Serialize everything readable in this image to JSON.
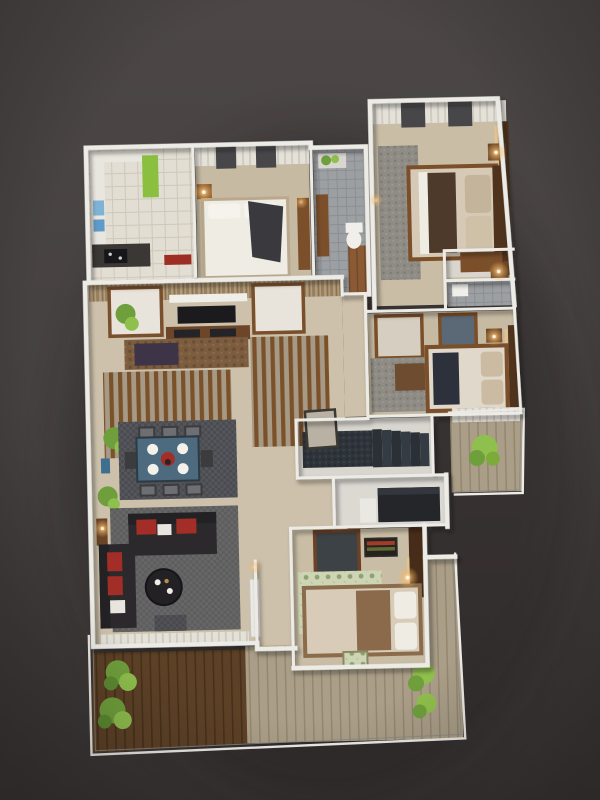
{
  "scene": {
    "type": "3d-floor-plan-render",
    "view": "top-down axonometric apartment floor plan on dark studio backdrop",
    "title": "",
    "visible_text": ""
  },
  "colors": {
    "bg-top": "#4c4746",
    "bg-bottom": "#393534",
    "shadow": "#242120",
    "wall": "#edebe6",
    "floor-living": "#cdc1ab",
    "floor-bed": "#c6baa3",
    "floor-master": "#c9bda6",
    "floor-kitchen": "#e3ded3",
    "bath-tile": "#9da0a3",
    "curtain-light": "#e4e1d9",
    "curtain-dark": "#d0ccc2",
    "window-dark": "#47474a",
    "wood": "#7b4f2a",
    "wood-dark": "#4f331c",
    "wood-mid": "#8a5a34",
    "deck-dark": "#5d4126",
    "deck-light": "#aa9e88",
    "sofa-dark": "#2b292c",
    "accent-red": "#a32d27",
    "table-blue": "#4e6a7e",
    "plate-white": "#f3f1ea",
    "rug-dark": "#55565b",
    "rug-gray": "#8f8c85",
    "rug-brown": "#7c5d3f",
    "rug-green": "#cdd5b4",
    "stairs-granite": "#2e343a",
    "plant-green": "#6f9f3c",
    "plant-green-light": "#8fbf4d",
    "green-cabinet": "#8abf3f",
    "lamp-glow": "#ffd29a",
    "tv-dark": "#1b1b1e",
    "purple-ottoman": "#3e3447",
    "navy-throw": "#2c313c",
    "blanket-brown": "#8a6a4a",
    "linen-white": "#efece4",
    "linen-beige": "#d6cab6"
  },
  "rooms": [
    {
      "name": "kitchen",
      "features": [
        "white-cabinets",
        "green-tall-cabinet",
        "blue-appliances",
        "black-cooktop",
        "red-floor-mat",
        "cream-tile-floor"
      ]
    },
    {
      "name": "bedroom-top",
      "features": [
        "curtain-wall",
        "white-double-bed",
        "dark-gray-throw",
        "nightstand-lamp",
        "wood-wardrobe"
      ]
    },
    {
      "name": "bathroom-top",
      "features": [
        "gray-tile-floor",
        "toilet",
        "wood-vanity",
        "window-plant"
      ]
    },
    {
      "name": "master-bedroom",
      "features": [
        "curtain-wall",
        "double-bed",
        "two-nightstand-lamps",
        "wood-accent-wall-backlit",
        "area-rug"
      ]
    },
    {
      "name": "walk-in-closet",
      "features": [
        "wood-wardrobe"
      ]
    },
    {
      "name": "master-bathroom",
      "features": [
        "gray-tile-floor",
        "toilet"
      ]
    },
    {
      "name": "living-room",
      "features": [
        "striped-wallpaper-wall",
        "two-framed-wardrobe-panels",
        "tv-unit",
        "wood-slat-partition",
        "brown-rug",
        "purple-ottoman",
        "corner-plants",
        "window-curtains"
      ]
    },
    {
      "name": "dining-area",
      "features": [
        "steel-blue-table",
        "six-dark-chairs",
        "four-white-plates",
        "red-centerpiece",
        "dark-rug"
      ]
    },
    {
      "name": "lounge",
      "features": [
        "two-dark-sofas",
        "red-cushions",
        "round-coffee-table",
        "gray-patterned-rug",
        "lit-console"
      ]
    },
    {
      "name": "hallway",
      "features": [
        "white-door",
        "marble-floor"
      ]
    },
    {
      "name": "stairwell",
      "features": [
        "granite-steps",
        "framed-art",
        "landing"
      ]
    },
    {
      "name": "study",
      "features": [
        "dark-desk",
        "white-appliance"
      ]
    },
    {
      "name": "bedroom-bottom",
      "features": [
        "green-pattern-rug",
        "bed-with-brown-blanket",
        "striped-wall-art",
        "tv-panel",
        "backlit-wood-pillar",
        "lattice-window"
      ]
    },
    {
      "name": "balcony-right",
      "features": [
        "plank-deck",
        "fern-plant",
        "curtain-wall",
        "glass-parapet"
      ]
    },
    {
      "name": "terrace",
      "features": [
        "dark-wood-deck",
        "light-wood-deck",
        "four-green-shrubs",
        "glass-parapet"
      ]
    }
  ]
}
